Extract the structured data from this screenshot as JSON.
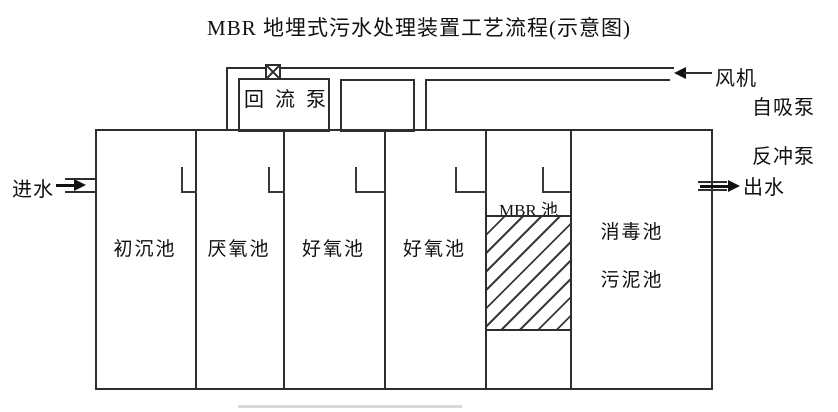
{
  "title": "MBR 地埋式污水处理装置工艺流程(示意图)",
  "io": {
    "inlet": "进水",
    "outlet": "出水"
  },
  "equipment": {
    "fan": "风机",
    "self_priming_pump": "自吸泵",
    "backwash_pump": "反冲泵",
    "reflux_pump": "回流泵"
  },
  "tanks": [
    {
      "label": "初沉池"
    },
    {
      "label": "厌氧池"
    },
    {
      "label": "好氧池"
    },
    {
      "label": "好氧池"
    },
    {
      "label": "MBR 池"
    },
    {
      "label": "消毒池"
    },
    {
      "label": "污泥池"
    }
  ],
  "colors": {
    "line": "#2e2e2e",
    "text": "#111111",
    "background": "#ffffff",
    "membrane_hatch": "#3a3a3a",
    "underline": "#d9d9d9"
  }
}
